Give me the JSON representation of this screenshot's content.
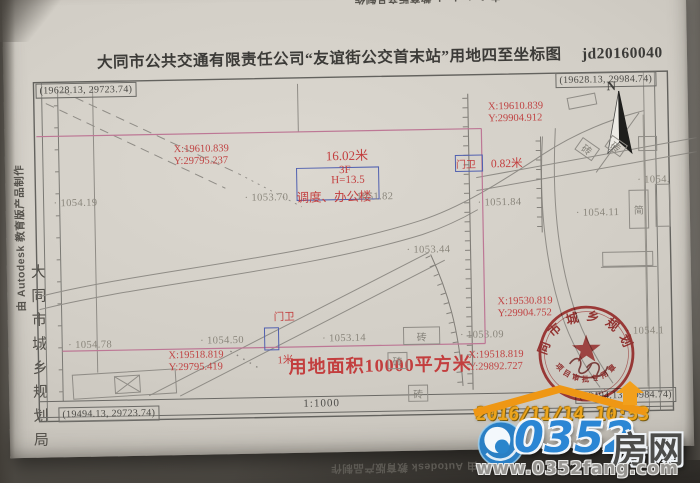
{
  "title": {
    "text": "大同市公共交通有限责任公司“友谊街公交首末站”用地四至坐标图",
    "code": "jd20160040"
  },
  "credits": {
    "autodesk": "由 Autodesk 教育版产品制作",
    "bureau": "大同市城乡规划局"
  },
  "frame": {
    "corner_tl": "(19628.13, 29723.74)",
    "corner_tr": "(19628.13, 29984.74)",
    "corner_bl": "(19494.13, 29723.74)",
    "corner_br": "(19494.13, 29984.74)",
    "scale": "1:1000",
    "north_label": "N"
  },
  "parcel": {
    "area_label": "用地面积10000平方米",
    "corner_coords": [
      {
        "x": "X:19610.839",
        "y": "Y:29795.237"
      },
      {
        "x": "X:19610.839",
        "y": "Y:29904.912"
      },
      {
        "x": "X:19518.819",
        "y": "Y:29795.419"
      },
      {
        "x": "X:19530.819",
        "y": "Y:29904.752"
      },
      {
        "x": "X:19518.819",
        "y": "Y:29892.727"
      }
    ],
    "dim_north": "16.02米",
    "dim_east": "0.82米",
    "dim_south": "1米"
  },
  "buildings": {
    "office_floors": "3F",
    "office_height": "H=13.5",
    "office_name": "调度、办公楼",
    "guard_north": "门卫",
    "guard_south": "门卫",
    "materials": [
      "砖",
      "砖",
      "砖",
      "砖",
      "砖",
      "简"
    ]
  },
  "elevations": [
    "1054.19",
    "1053.70",
    "1051.82",
    "1051.84",
    "1053.44",
    "1054.50",
    "1053.14",
    "1054.78",
    "1053.09",
    "1054.11",
    "1054.1",
    "1054."
  ],
  "stamp": {
    "agency": "大同市城乡规划局",
    "purpose": "项目审批专用章",
    "serial": "1040000281611"
  },
  "overlay": {
    "datestamp": "2016/11/14 10:53",
    "site_number": "0352",
    "site_name": "房网",
    "site_url": "www.0352fang.com"
  }
}
